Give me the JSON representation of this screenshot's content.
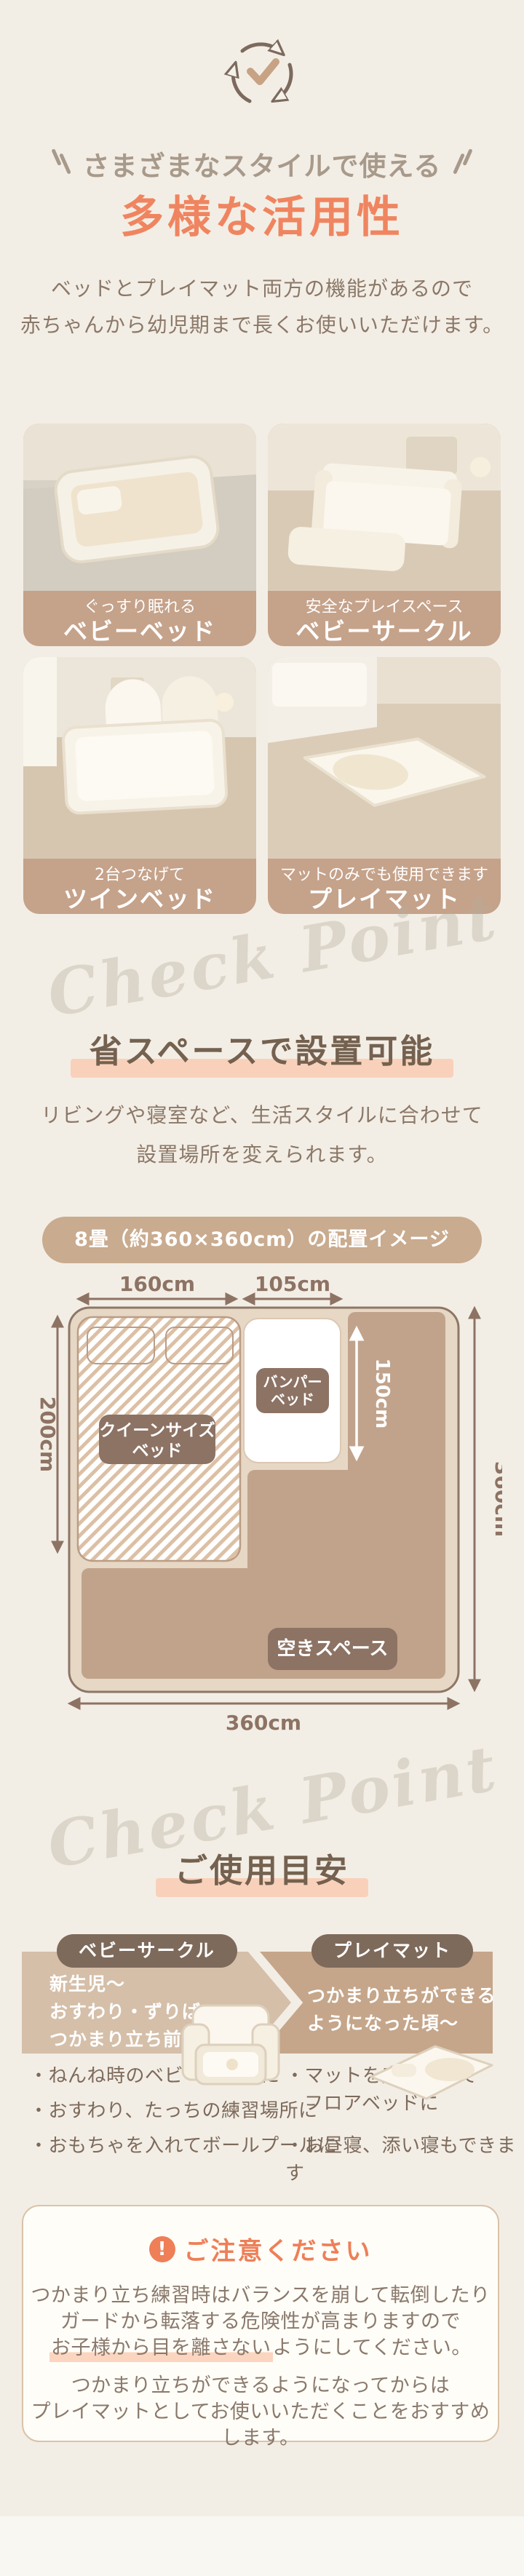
{
  "colors": {
    "accent_orange": "#ef8560",
    "highlight_peach": "#f9d1bb",
    "caption_band_tan": "#c5a28a",
    "floor_tan": "#c1a38c",
    "label_brown": "#8d7364"
  },
  "intro": {
    "heading_small": "さまざまなスタイルで使える",
    "title": "多様な活用性",
    "body_line1": "ベッドとプレイマット両方の機能があるので",
    "body_line2": "赤ちゃんから幼児期まで長くお使いいただけます。"
  },
  "usage_cards": [
    {
      "caption": "ぐっすり眠れる",
      "title": "ベビーベッド"
    },
    {
      "caption": "安全なプレイスペース",
      "title": "ベビーサークル"
    },
    {
      "caption": "2台つなげて",
      "title": "ツインベッド"
    },
    {
      "caption": "マットのみでも使用できます",
      "title": "プレイマット"
    }
  ],
  "layout_section": {
    "watermark": "Check Point",
    "heading": "省スペースで設置可能",
    "body_line1": "リビングや寝室など、生活スタイルに合わせて",
    "body_line2": "設置場所を変えられます。",
    "badge": "8畳（約360×360cm）の配置イメージ",
    "floorplan": {
      "dim_top_left": "160cm",
      "dim_top_right": "105cm",
      "dim_left": "200cm",
      "dim_inner": "150cm",
      "dim_right": "360cm",
      "dim_bottom": "360cm",
      "queen_label_line1": "クイーンサイズ",
      "queen_label_line2": "ベッド",
      "bumper_label_line1": "バンパー",
      "bumper_label_line2": "ベッド",
      "empty_label": "空きスペース"
    }
  },
  "guide_section": {
    "watermark": "Check Point",
    "heading": "ご使用目安",
    "circle": {
      "label": "ベビーサークル",
      "period_line1": "新生児〜",
      "period_line2": "おすわり・ずりばい・",
      "period_line3": "つかまり立ち前まで",
      "bullets": [
        "・ねんね時のベビーベッドに",
        "・おすわり、たっちの練習場所に",
        "・おもちゃを入れてボールプールに"
      ]
    },
    "mat": {
      "label": "プレイマット",
      "period_line1": "つかまり立ちができる",
      "period_line2": "ようになった頃〜",
      "bullet1_line1": "・マットを床に敷いて",
      "bullet1_line2": "フロアベッドに",
      "bullet2": "・お昼寝、添い寝もできます"
    }
  },
  "caution": {
    "icon_mark": "!",
    "title": "ご注意ください",
    "p1_line1": "つかまり立ち練習時はバランスを崩して転倒したり",
    "p1_line2": "ガードから転落する危険性が高まりますので",
    "p1_line3_hl": "お子様から目を離さない",
    "p1_line3_rest": "ようにしてください。",
    "p2_line1": "つかまり立ちができるようになってからは",
    "p2_line2": "プレイマットとしてお使いいただくことをおすすめします。"
  }
}
